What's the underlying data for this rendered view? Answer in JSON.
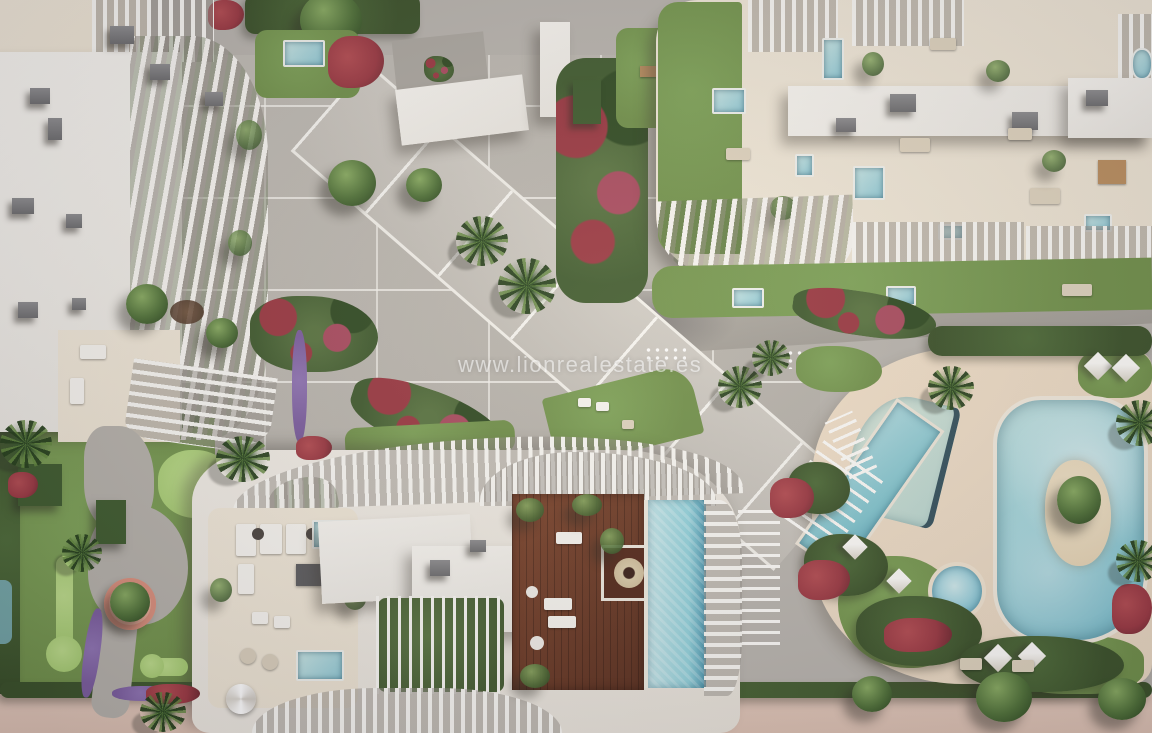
{
  "watermark": {
    "text": "www.lionrealestate.es"
  },
  "palette": {
    "paving": "#b7b3ad",
    "paving-light": "#cac6bf",
    "roof-white": "#f2f0ea",
    "terrace-cream": "#ece3d2",
    "deck-sand": "#e9d8c2",
    "lawn": "#6f8f49",
    "putting-green": "#a6cc72",
    "hedge": "#3a5129",
    "flower-red": "#993741",
    "flower-magenta": "#a84a5e",
    "flower-purple": "#7b5d9e",
    "water": "#8fc8d4",
    "water-light": "#c6e4e3",
    "water-deep": "#5fa8bb",
    "island-sand": "#e6d4b4",
    "wood-deck": "#7c442c",
    "vent-grey": "#6c6c6e",
    "road": "#a5a29c",
    "beach-path": "#dbc0b1",
    "planter-pink": "#e3a893"
  }
}
